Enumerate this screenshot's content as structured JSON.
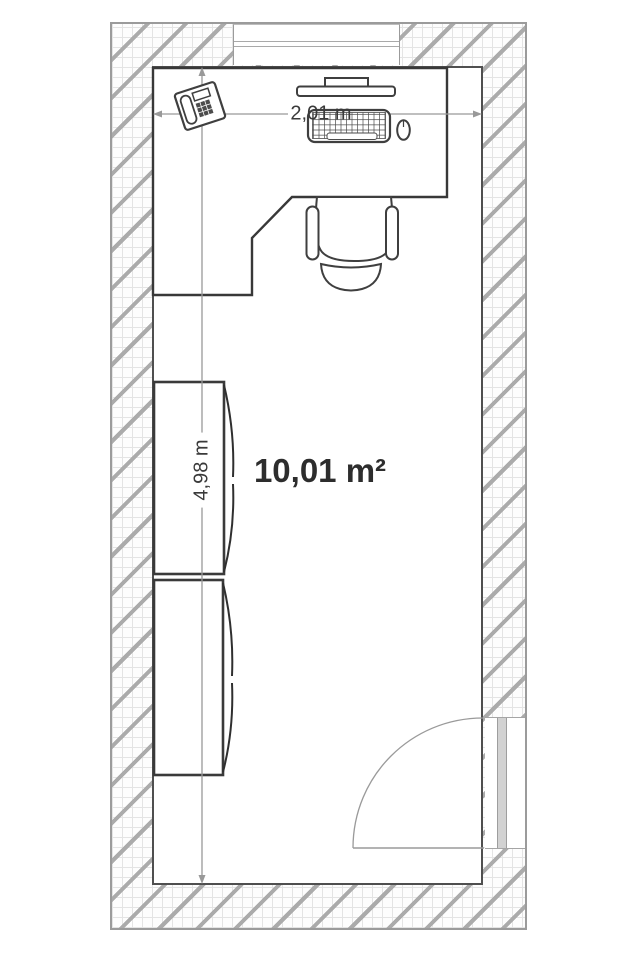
{
  "plan": {
    "room": {
      "area_label": "10,01 m²",
      "width_label": "2,01 m",
      "height_label": "4,98 m"
    },
    "objects": [
      {
        "name": "corner-desk"
      },
      {
        "name": "office-chair"
      },
      {
        "name": "monitor"
      },
      {
        "name": "keyboard"
      },
      {
        "name": "mouse"
      },
      {
        "name": "desk-phone"
      },
      {
        "name": "cabinet-upper"
      },
      {
        "name": "cabinet-lower"
      },
      {
        "name": "door"
      },
      {
        "name": "window"
      }
    ],
    "colors": {
      "wall_hatch": "#ababab",
      "room_outline": "#4f4f4f",
      "furniture_outline": "#3c3c3c",
      "dimension_line": "#9a9a9a",
      "label_text": "#2d2d2d",
      "door_leaf": "#d2d2d2"
    }
  }
}
